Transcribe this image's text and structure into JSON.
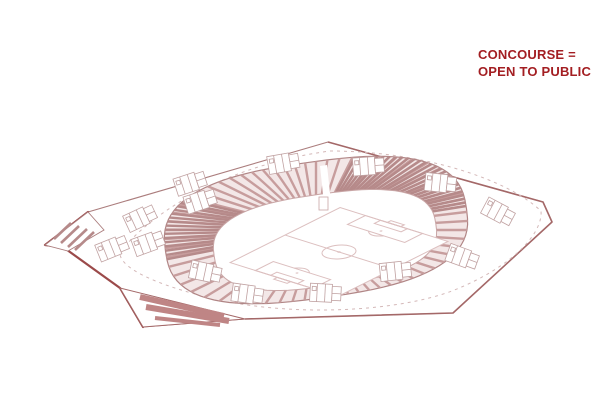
{
  "annotation": {
    "line1": "CONCOURSE =",
    "line2": "OPEN TO PUBLIC",
    "color": "#a31e22"
  },
  "drawing": {
    "colors": {
      "annotation": "#a31e22",
      "outline": "#ab7d7d",
      "outline_heavy": "#9b4a4a",
      "outline_medium": "#a46868",
      "bowl_fill": "#f3e7e7",
      "stripe": "#c79d9d",
      "stripe_dense": "#b68a8a",
      "inner_edge": "#c9a6a6",
      "pitch_line": "#dcbfbf",
      "kiosk_line": "#c0a1a1",
      "plaza_stripe": "#bf8585",
      "dashed": "#d4b8b8"
    },
    "stripes": {
      "main_count": 64,
      "dense_start": -72,
      "dense_end": -14,
      "dense_step": 2.2,
      "dense2_start": 162,
      "dense2_end": 202,
      "dense2_step": 2.6
    },
    "kiosks": [
      {
        "x": 190,
        "y": 183,
        "r": -18
      },
      {
        "x": 283,
        "y": 163,
        "r": -10
      },
      {
        "x": 368,
        "y": 166,
        "r": -4
      },
      {
        "x": 440,
        "y": 183,
        "r": 6
      },
      {
        "x": 498,
        "y": 212,
        "r": 28
      },
      {
        "x": 200,
        "y": 201,
        "r": -18
      },
      {
        "x": 140,
        "y": 218,
        "r": -25
      },
      {
        "x": 112,
        "y": 248,
        "r": -22
      },
      {
        "x": 148,
        "y": 243,
        "r": -20
      },
      {
        "x": 205,
        "y": 272,
        "r": 12
      },
      {
        "x": 247,
        "y": 294,
        "r": 8
      },
      {
        "x": 325,
        "y": 293,
        "r": 3
      },
      {
        "x": 395,
        "y": 271,
        "r": -6
      },
      {
        "x": 462,
        "y": 257,
        "r": 20
      }
    ]
  }
}
